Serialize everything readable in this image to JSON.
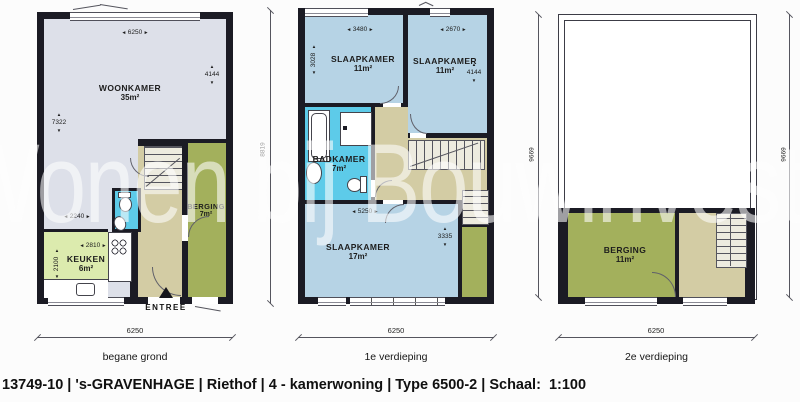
{
  "watermark": "Wonen bij Bouwinvest",
  "caption": "13749-10 | 's-GRAVENHAGE | Riethof | 4 - kamerwoning | Type 6500-2 | Schaal:  1:100",
  "colors": {
    "wall": "#1b1b24",
    "living": "#dde0e9",
    "bedroom": "#b6d3e5",
    "bath": "#5dcbe9",
    "kitchen": "#dcebae",
    "storage": "#a3b05c",
    "hall": "#d3cca4",
    "stair": "#edebdf",
    "dim": "#1c1c1c"
  },
  "plans": [
    {
      "label": "begane grond",
      "entree_label": "ENTREE",
      "rooms": [
        {
          "name": "WOONKAMER",
          "area": "35m²"
        },
        {
          "name": "KEUKEN",
          "area": "6m²"
        },
        {
          "name": "BERGING",
          "area": "7m²"
        }
      ],
      "dims": {
        "width_top": "6250",
        "height_right": "4144",
        "height_left": "7322",
        "hall_width": "2240",
        "kitchen_width": "2810",
        "kitchen_height": "2100",
        "width_bottom": "6250"
      }
    },
    {
      "label": "1e verdieping",
      "rooms": [
        {
          "name": "SLAAPKAMER",
          "area": "11m²"
        },
        {
          "name": "SLAAPKAMER",
          "area": "11m²"
        },
        {
          "name": "BADKAMER",
          "area": "7m²"
        },
        {
          "name": "SLAAPKAMER",
          "area": "17m²"
        }
      ],
      "dims": {
        "room1_width": "3480",
        "room1_height": "3028",
        "room2_width": "2670",
        "room2_height": "4144",
        "total_height": "8819",
        "room4_width": "5250",
        "room4_height": "3335",
        "width_bottom": "6250"
      }
    },
    {
      "label": "2e verdieping",
      "rooms": [
        {
          "name": "BERGING",
          "area": "11m²"
        }
      ],
      "dims": {
        "height_left": "9669",
        "height_right": "9669",
        "width_bottom": "6250"
      }
    }
  ]
}
